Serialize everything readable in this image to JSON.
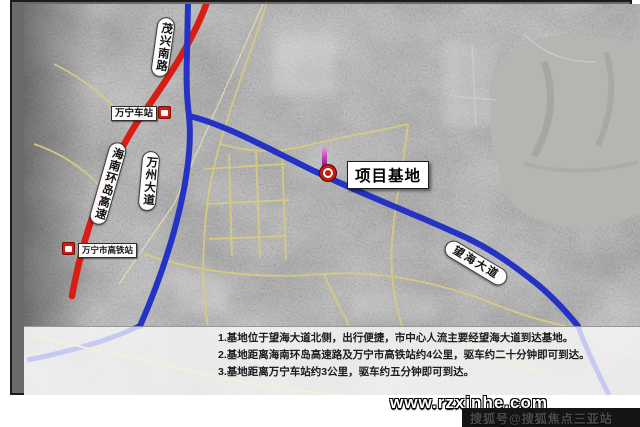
{
  "map": {
    "labels": {
      "maoxing_road": "茂兴南路",
      "ring_expressway": "海南环岛高速",
      "wanzhou_avenue": "万州大道",
      "wanghai_avenue": "望海大道",
      "wanning_station": "万宁车站",
      "wanning_hsr_station": "万宁市高铁站",
      "project_base": "项目基地"
    },
    "colors": {
      "expressway_red": "#d81e14",
      "avenue_blue": "#2433c4",
      "minor_road_yellow": "#d8cd7c",
      "water_gray": "#b4b7b1",
      "marker_red": "#cf1d12",
      "marker_purple": "#b73ab8"
    }
  },
  "notes": {
    "lines": [
      "1.基地位于望海大道北侧，出行便捷，市中心人流主要经望海大道到达基地。",
      "2.基地距离海南环岛高速路及万宁市高铁站约4公里，驱车约二十分钟即可到达。",
      "3.基地距离万宁车站约3公里，驱车约五分钟即可到达。"
    ]
  },
  "watermark": {
    "site_url": "www.rzxinhe.com",
    "credit": "搜狐号@搜狐焦点三亚站"
  }
}
